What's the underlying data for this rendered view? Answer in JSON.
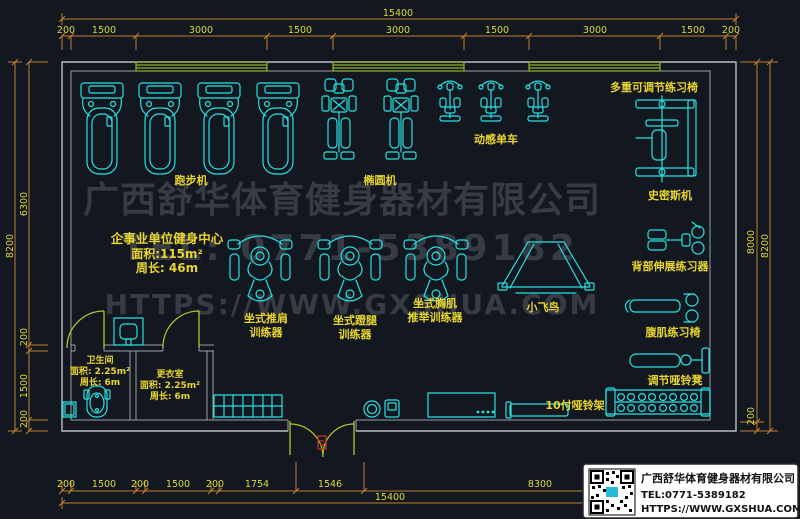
{
  "colors": {
    "background": "#131720",
    "dimension_line": "#c17f2f",
    "dimension_text": "#d9d93a",
    "wall": "#b9bdc2",
    "equipment": "#27e2e2",
    "window": "#8fb32a",
    "door": "#b4c22e",
    "label": "#e8d530",
    "watermark": "#363b44",
    "door_mat_red": "#c03028",
    "titleblock_bg": "#ffffff",
    "titleblock_text": "#111111"
  },
  "watermark": {
    "line1": "广西舒华体育健身器材有限公司",
    "line2": "TEL: 0771-5389182",
    "line3": "HTTPS://WWW.GXSHUA.COM"
  },
  "info": {
    "title": "企事业单位健身中心",
    "area": "面积:115m²",
    "perimeter": "周长: 46m"
  },
  "rooms": {
    "bathroom": {
      "name": "卫生间",
      "area": "面积: 2.25m²",
      "perimeter": "周长: 6m"
    },
    "changing": {
      "name": "更衣室",
      "area": "面积: 2.25m²",
      "perimeter": "周长: 6m"
    }
  },
  "labels": {
    "treadmill": "跑步机",
    "elliptical": "椭圆机",
    "spin_bike": "动感单车",
    "adjustable_bench": "多重可调节练习椅",
    "smith_machine": "史密斯机",
    "back_extension": "背部伸展练习器",
    "ab_bench": "腹肌练习椅",
    "dumbbell_bench": "调节哑铃凳",
    "shoulder_press_1": "坐式推肩",
    "shoulder_press_2": "训练器",
    "leg_press_1": "坐式蹬腿",
    "leg_press_2": "训练器",
    "chest_press_1": "坐式胸肌",
    "chest_press_2": "推举训练器",
    "cable_fly": "小飞鸟",
    "dumbbell_rack": "10付哑铃架"
  },
  "dimensions": {
    "top_total": "15400",
    "top_segments": [
      "200",
      "1500",
      "3000",
      "1500",
      "3000",
      "1500",
      "3000",
      "1500",
      "200"
    ],
    "bottom_total": "15400",
    "bottom_segments": [
      "200",
      "1500",
      "200",
      "1500",
      "200",
      "1754",
      "1546",
      "8300"
    ],
    "left_total": "8200",
    "left_segments": [
      "6300",
      "200",
      "1500",
      "200"
    ],
    "right_inner": "8000",
    "right_total": "8200",
    "right_bottom": "200"
  },
  "title_block": {
    "company": "广西舒华体育健身器材有限公司",
    "tel": "TEL:0771-5389182",
    "url": "HTTPS://WWW.GXSHUA.COM"
  }
}
